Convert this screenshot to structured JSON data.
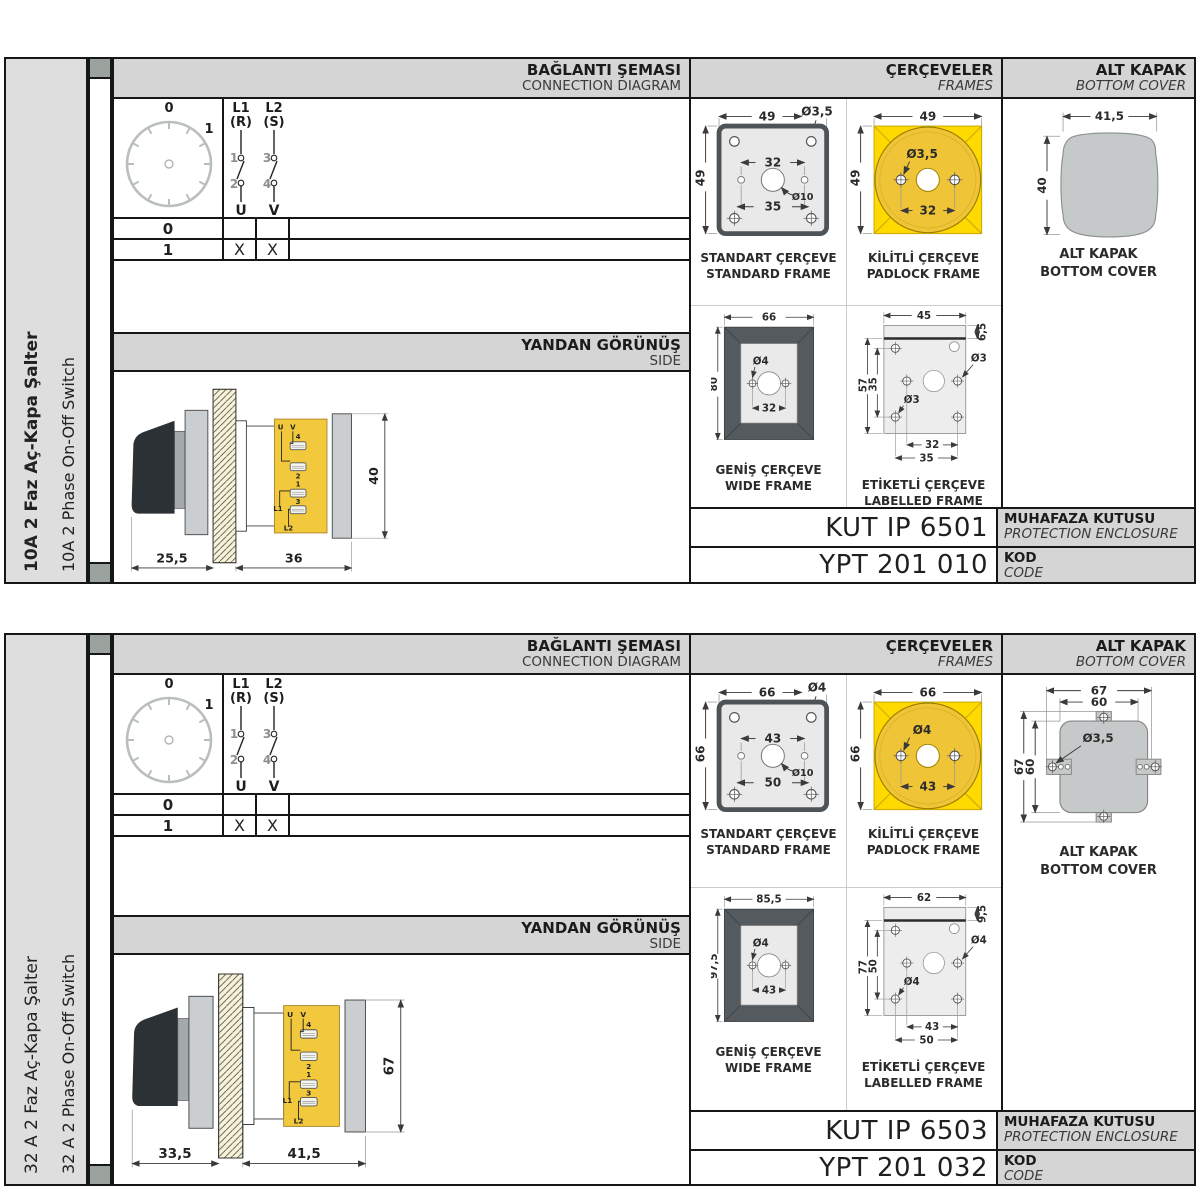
{
  "colors": {
    "accent_yellow": "#ffd900",
    "dial_yellow": "#f0c437",
    "frame_dark": "#545a5e",
    "header_gray": "#d5d5d5",
    "sidebar_gray": "#dedede",
    "cover_gray": "#c6c9c9",
    "tab_square": "#9aa29e"
  },
  "panels": [
    {
      "sidebar": {
        "title_tr": "10A 2 Faz Aç-Kapa Şalter",
        "title_en": "10A 2 Phase On-Off Switch",
        "bold": true
      },
      "connection": {
        "header_tr": "BAĞLANTI ŞEMASI",
        "header_en": "CONNECTION DIAGRAM",
        "dial": {
          "pos_top": "0",
          "pos_right": "1"
        },
        "contacts": {
          "p1": "L1",
          "p1_sub": "(R)",
          "p2": "L2",
          "p2_sub": "(S)",
          "t1": "1",
          "t2": "2",
          "t3": "3",
          "t4": "4",
          "out1": "U",
          "out2": "V"
        },
        "table": {
          "rows": [
            {
              "label": "0",
              "u": "",
              "v": ""
            },
            {
              "label": "1",
              "u": "X",
              "v": "X"
            }
          ]
        }
      },
      "side": {
        "header_tr": "YANDAN GÖRÜNÜŞ",
        "header_en": "SIDE",
        "dim_front": "25,5",
        "dim_body": "36",
        "dim_height": "40",
        "terminals": {
          "u": "U",
          "v": "V",
          "n4": "4",
          "n2": "2",
          "n1": "1",
          "n3": "3",
          "l1": "L1",
          "l2": "L2"
        }
      },
      "frames": {
        "header_tr": "ÇERÇEVELER",
        "header_en": "FRAMES",
        "standard": {
          "label_tr": "STANDART ÇERÇEVE",
          "label_en": "STANDARD FRAME",
          "dim_w": "49",
          "dim_h": "49",
          "hole": "Ø3,5",
          "dim_inner": "32",
          "dim_outer": "35",
          "center_hole": "Ø10"
        },
        "padlock": {
          "label_tr": "KİLİTLİ ÇERÇEVE",
          "label_en": "PADLOCK FRAME",
          "dim_w": "49",
          "dim_h": "49",
          "hole": "Ø3,5",
          "dim_inner": "32"
        },
        "wide": {
          "label_tr": "GENİŞ ÇERÇEVE",
          "label_en": "WIDE FRAME",
          "dim_w": "66",
          "dim_h": "80",
          "hole": "Ø4",
          "dim_inner": "32"
        },
        "labelled": {
          "label_tr": "ETİKETLİ ÇERÇEVE",
          "label_en": "LABELLED FRAME",
          "dim_w": "45",
          "dim_strip": "6,5",
          "dim_h": "57",
          "dim_inner_h": "35",
          "hole_r": "Ø3",
          "hole_b": "Ø3",
          "dim_inner": "32",
          "dim_outer": "35"
        }
      },
      "cover": {
        "header_tr": "ALT KAPAK",
        "header_en": "BOTTOM COVER",
        "label_tr": "ALT KAPAK",
        "label_en": "BOTTOM COVER",
        "show_plain": true,
        "plain": {
          "dim_w": "41,5",
          "dim_h": "40"
        }
      },
      "enclosure": {
        "value": "KUT IP 6501",
        "label_tr": "MUHAFAZA KUTUSU",
        "label_en": "PROTECTION ENCLOSURE"
      },
      "code": {
        "value": "YPT 201 010",
        "label_tr": "KOD",
        "label_en": "CODE"
      }
    },
    {
      "sidebar": {
        "title_tr": "32 A 2 Faz Aç-Kapa Şalter",
        "title_en": "32 A 2 Phase On-Off Switch",
        "bold": false
      },
      "connection": {
        "header_tr": "BAĞLANTI ŞEMASI",
        "header_en": "CONNECTION DIAGRAM",
        "dial": {
          "pos_top": "0",
          "pos_right": "1"
        },
        "contacts": {
          "p1": "L1",
          "p1_sub": "(R)",
          "p2": "L2",
          "p2_sub": "(S)",
          "t1": "1",
          "t2": "2",
          "t3": "3",
          "t4": "4",
          "out1": "U",
          "out2": "V"
        },
        "table": {
          "rows": [
            {
              "label": "0",
              "u": "",
              "v": ""
            },
            {
              "label": "1",
              "u": "X",
              "v": "X"
            }
          ]
        }
      },
      "side": {
        "header_tr": "YANDAN GÖRÜNÜŞ",
        "header_en": "SIDE",
        "dim_front": "33,5",
        "dim_body": "41,5",
        "dim_height": "67",
        "terminals": {
          "u": "U",
          "v": "V",
          "n4": "4",
          "n2": "2",
          "n1": "1",
          "n3": "3",
          "l1": "L1",
          "l2": "L2"
        }
      },
      "frames": {
        "header_tr": "ÇERÇEVELER",
        "header_en": "FRAMES",
        "standard": {
          "label_tr": "STANDART ÇERÇEVE",
          "label_en": "STANDARD FRAME",
          "dim_w": "66",
          "dim_h": "66",
          "hole": "Ø4",
          "dim_inner": "43",
          "dim_outer": "50",
          "center_hole": "Ø10"
        },
        "padlock": {
          "label_tr": "KİLİTLİ ÇERÇEVE",
          "label_en": "PADLOCK FRAME",
          "dim_w": "66",
          "dim_h": "66",
          "hole": "Ø4",
          "dim_inner": "43"
        },
        "wide": {
          "label_tr": "GENİŞ ÇERÇEVE",
          "label_en": "WIDE FRAME",
          "dim_w": "85,5",
          "dim_h": "97,5",
          "hole": "Ø4",
          "dim_inner": "43"
        },
        "labelled": {
          "label_tr": "ETİKETLİ ÇERÇEVE",
          "label_en": "LABELLED FRAME",
          "dim_w": "62",
          "dim_strip": "9,5",
          "dim_h": "77",
          "dim_inner_h": "50",
          "hole_r": "Ø4",
          "hole_b": "Ø4",
          "dim_inner": "43",
          "dim_outer": "50"
        }
      },
      "cover": {
        "header_tr": "ALT KAPAK",
        "header_en": "BOTTOM COVER",
        "label_tr": "ALT KAPAK",
        "label_en": "BOTTOM COVER",
        "show_tabbed": true,
        "tabbed": {
          "dim_w_outer": "67",
          "dim_w_inner": "60",
          "dim_h_outer": "67",
          "dim_h_inner": "60",
          "hole": "Ø3,5"
        }
      },
      "enclosure": {
        "value": "KUT IP 6503",
        "label_tr": "MUHAFAZA KUTUSU",
        "label_en": "PROTECTION ENCLOSURE"
      },
      "code": {
        "value": "YPT 201 032",
        "label_tr": "KOD",
        "label_en": "CODE"
      }
    }
  ]
}
